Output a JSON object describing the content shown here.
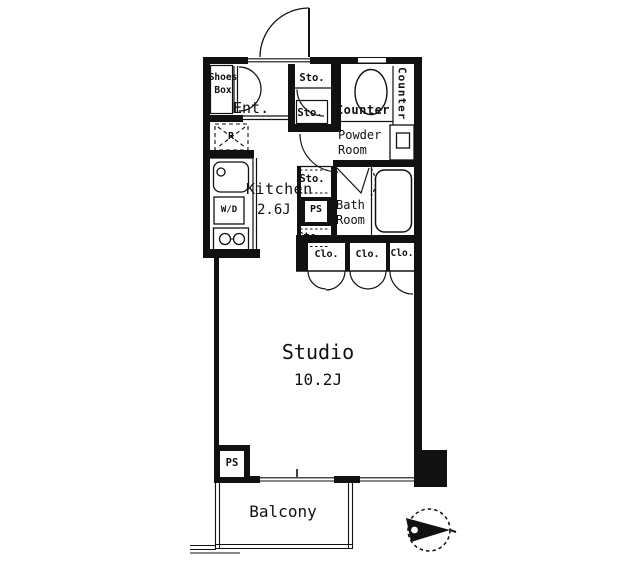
{
  "floorplan": {
    "rooms": {
      "entrance": "Ent.",
      "kitchen": {
        "name": "Kitchen",
        "size": "2.6J"
      },
      "powder_room": "Powder\nRoom",
      "bath_room": "Bath\nRoom",
      "studio": {
        "name": "Studio",
        "size": "10.2J"
      },
      "balcony": "Balcony"
    },
    "storage": {
      "shoes_box": "Shoes\nBox",
      "sto_entrance": "Sto.",
      "sto_hall_upper": "Sto.",
      "sto_hall_mid": "Sto.",
      "sto_hall_lower": "Sto.",
      "closet_1": "Clo.",
      "closet_2": "Clo.",
      "closet_3": "Clo."
    },
    "utilities": {
      "pipe_space_hall": "PS",
      "pipe_space_studio": "PS",
      "washer_dryer": "W/D",
      "refrigerator": "R"
    },
    "counters": {
      "toilet_side": "Counter",
      "powder_side": "Counter"
    },
    "colors": {
      "wall": "#111111",
      "background": "#ffffff",
      "text": "#111111"
    }
  }
}
